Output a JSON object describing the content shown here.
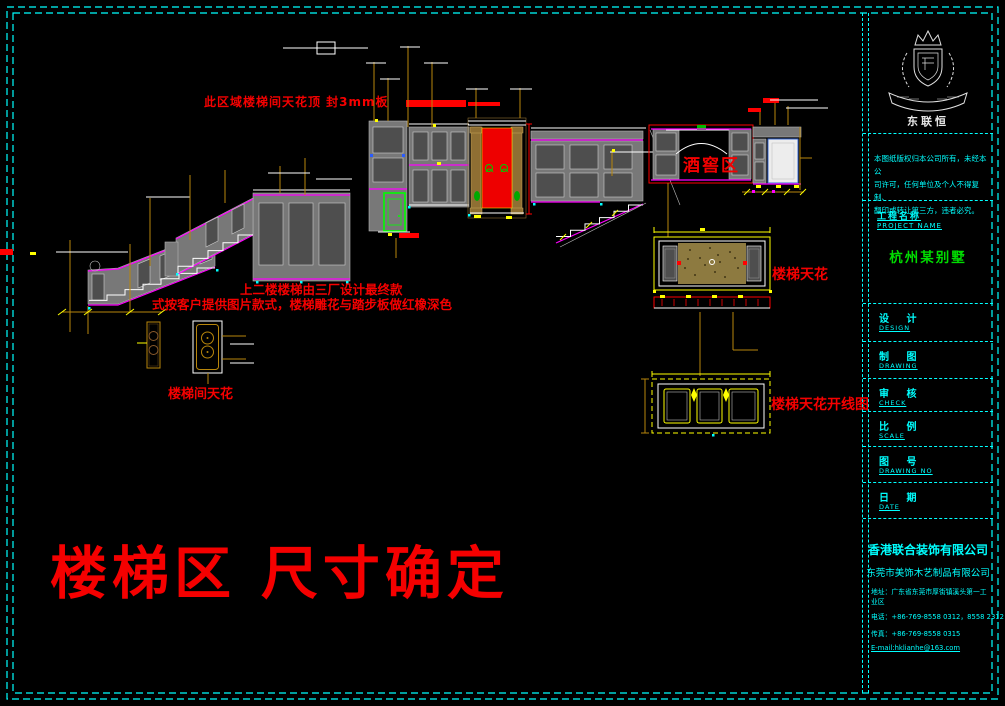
{
  "page": {
    "bg_color": "#000000",
    "border_color": "#00ffff",
    "accent_red": "#ff0000",
    "accent_magenta": "#ff00ff",
    "accent_gold": "#b8860b",
    "accent_green": "#00ff00",
    "accent_yellow": "#ffff00"
  },
  "annotations": {
    "top_note": "此区域楼梯间天花顶  封3mm板",
    "mid_note_line1": "上二楼楼梯由三厂设计最终款",
    "mid_note_line2": "式按客户提供图片款式，楼梯雕花与踏步板做红橡深色",
    "big_title": "楼梯区  尺寸确定"
  },
  "labels": {
    "wine_area": "酒窖区",
    "stair_ceiling": "楼梯天花",
    "stair_ceiling_layout": "楼梯天花开线图",
    "stairwell_ceiling": "楼梯间天花"
  },
  "titleblock": {
    "logo_icon": "company-crest",
    "logo_text": "东联恒",
    "disclaimer_lines": [
      "本图纸版权归本公司所有，未经本公",
      "司许可，任何单位及个人不得复制、",
      "翻印或转让第三方，违者必究。"
    ],
    "project_label": "工程名称",
    "project_label_en": "PROJECT NAME",
    "project_name": "杭州某别墅",
    "rows": [
      {
        "label": "设  计",
        "en": "DESIGN"
      },
      {
        "label": "制  图",
        "en": "DRAWING"
      },
      {
        "label": "审  核",
        "en": "CHECK"
      },
      {
        "label": "比  例",
        "en": "SCALE"
      },
      {
        "label": "图  号",
        "en": "DRAWING NO"
      },
      {
        "label": "日  期",
        "en": "DATE"
      }
    ],
    "company_cn": "香港联合装饰有限公司",
    "company_sub": "东莞市美饰木艺制品有限公司",
    "address": "地址：广东省东莞市厚街镇溪头第一工业区",
    "phone": "电话：+86-769-8558 0312，8558 2312",
    "fax": "传真：+86-769-8558 0315",
    "email": "E-mail:hklianhe@163.com"
  }
}
